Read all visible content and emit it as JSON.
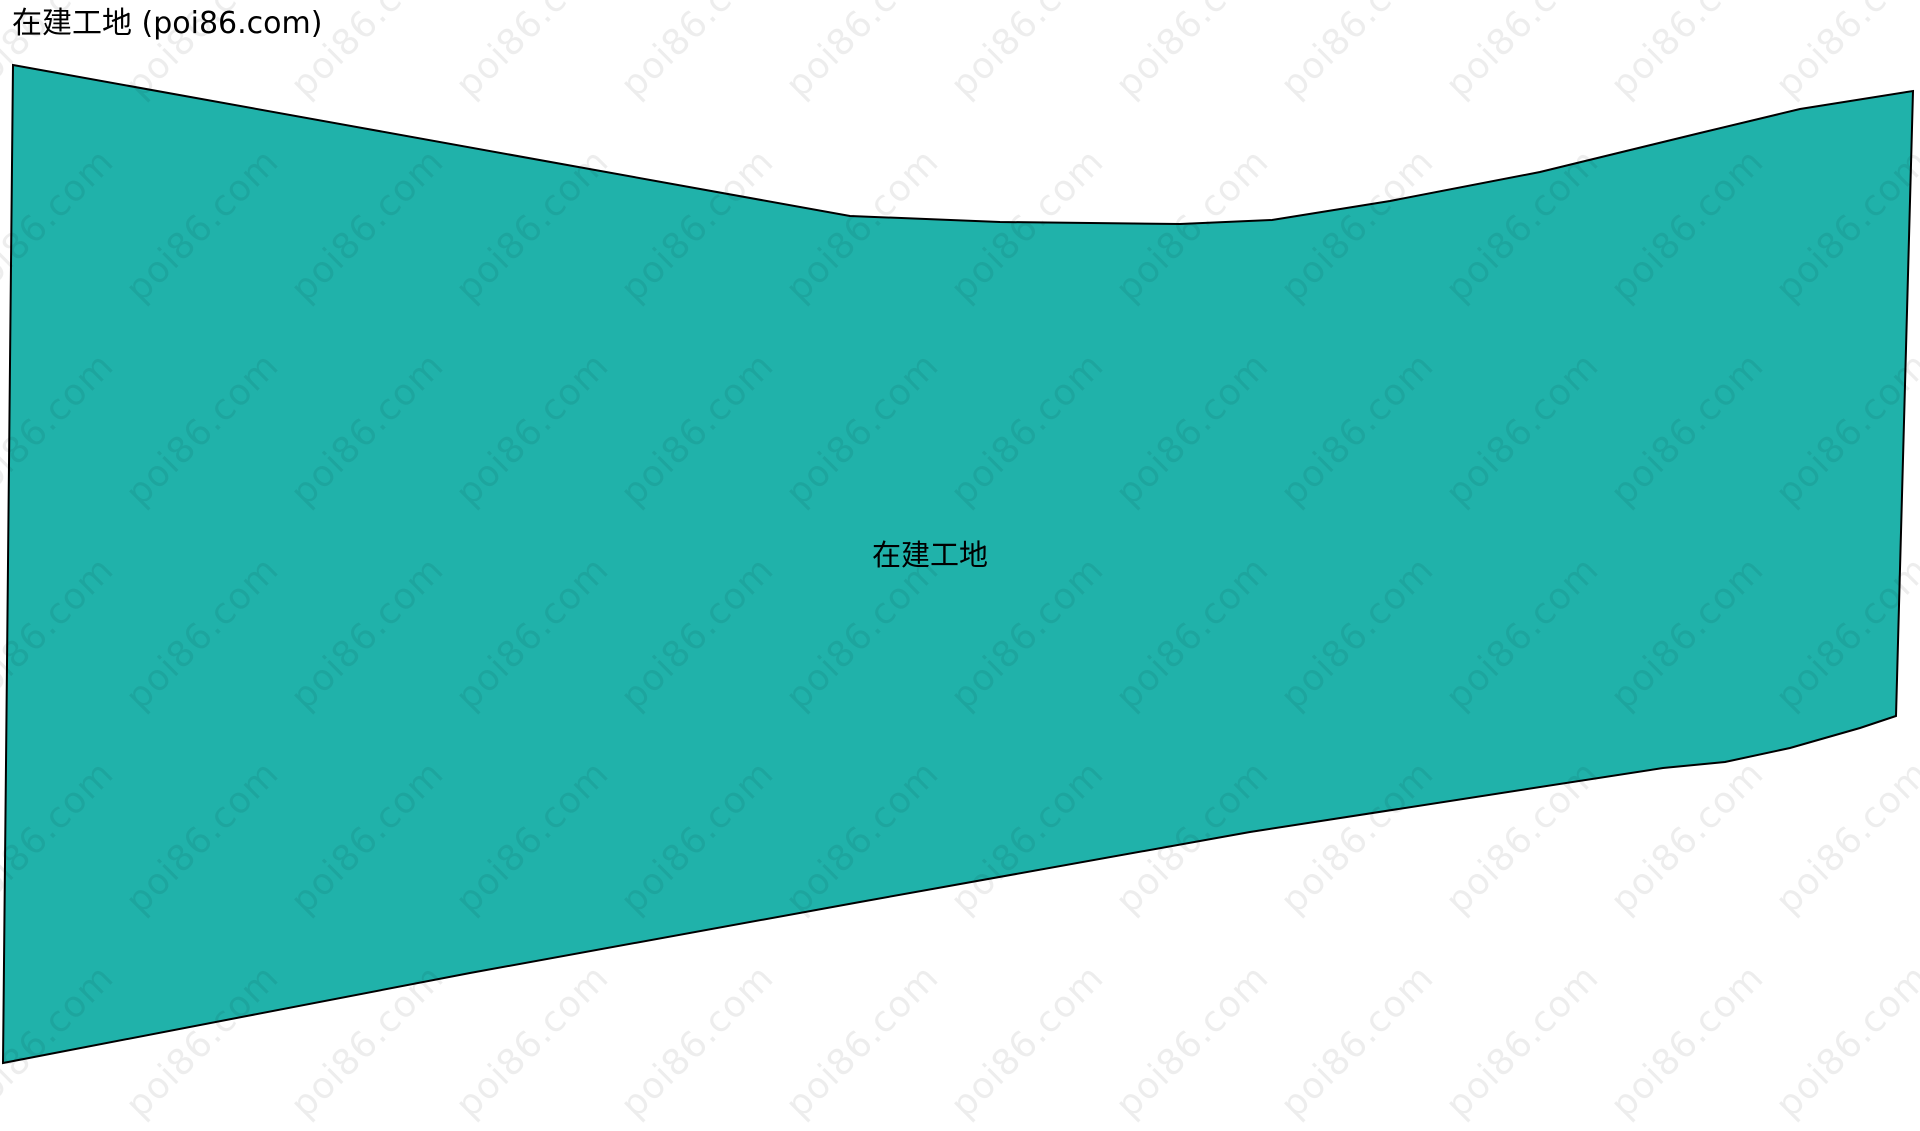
{
  "header": {
    "title": "在建工地 (poi86.com)"
  },
  "map": {
    "label": "在建工地",
    "fill_color": "#20B2AA",
    "stroke_color": "#000000",
    "background_color": "#ffffff",
    "polygon_points": "13,65 850,216 1000,222 1180,224 1272,220 1390,201 1540,172 1700,133 1800,109 1913,91 1896,716 1860,728 1790,748 1725,762 1663,768 1250,832 860,902 470,973 3,1063"
  },
  "watermark": {
    "text": "poi86.com"
  }
}
